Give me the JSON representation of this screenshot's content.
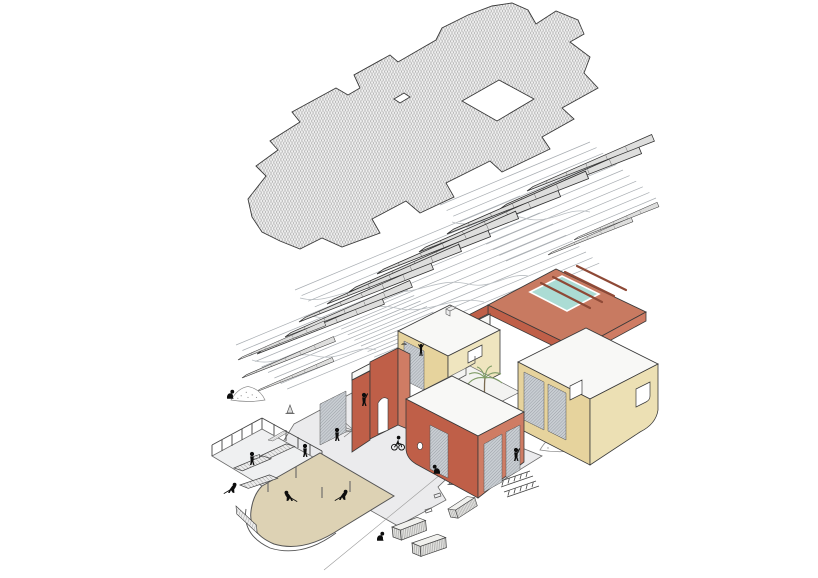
{
  "diagram": {
    "kind": "exploded-axonometric-construction-drawing",
    "layers": [
      "roof-plane-hatched",
      "truss-and-purlin-framing",
      "building-walls",
      "ground-plane-site-works"
    ]
  },
  "colors": {
    "background": "#ffffff",
    "line": "#3a3a3a",
    "roof_base": "#f0f0f0",
    "roof_hatch": "#6e6e6e",
    "purlin": "#a8adb2",
    "truss_fill": "#dededd",
    "terracotta": "#bf5f48",
    "terracotta_light": "#cf7c64",
    "terracotta_deck": "#c87a61",
    "beam_dark": "#8e4936",
    "wall_yellow": "#e6d39d",
    "wall_yellow_light": "#ece0b4",
    "pool": "#abdcd4",
    "slab_white": "#f8f8f6",
    "mesh": "#c9ced3",
    "ground": "#ebebed",
    "sand": "#ddd2b4",
    "figure": "#0d0d0d",
    "palm": "#7f9c66"
  },
  "purlin_bands": [
    {
      "x1": 440,
      "y1": 205,
      "x2": 590,
      "y2": 142,
      "n": 11,
      "dx": 6.6,
      "dy": 5.6
    },
    {
      "x1": 295,
      "y1": 290,
      "x2": 520,
      "y2": 196,
      "n": 13,
      "dx": 6.6,
      "dy": 5.6
    },
    {
      "x1": 236,
      "y1": 345,
      "x2": 395,
      "y2": 279,
      "n": 9,
      "dx": 6.4,
      "dy": 5.5
    }
  ],
  "stamps": [
    {
      "layer": "trusses",
      "sym": "sym-truss",
      "name": "roof-truss",
      "items": [
        {
          "x": 500,
          "y": 209,
          "r": -22.5
        },
        {
          "x": 527,
          "y": 191,
          "r": -22.5,
          "s": 0.9
        },
        {
          "x": 419,
          "y": 252,
          "r": -22.5
        },
        {
          "x": 447,
          "y": 234,
          "r": -22.5
        },
        {
          "x": 349,
          "y": 292,
          "r": -22.5
        },
        {
          "x": 377,
          "y": 274,
          "r": -22.5
        },
        {
          "x": 299,
          "y": 322,
          "r": -22.5,
          "s": 0.95
        },
        {
          "x": 327,
          "y": 304,
          "r": -22.5,
          "s": 0.95
        },
        {
          "x": 257,
          "y": 354,
          "r": -22.5,
          "s": 0.9
        },
        {
          "x": 285,
          "y": 337,
          "r": -22.5,
          "s": 0.9
        },
        {
          "x": 238,
          "y": 360,
          "r": -22.5,
          "s": 0.62
        },
        {
          "x": 242,
          "y": 378,
          "r": -22.5,
          "s": 0.66
        },
        {
          "x": 256,
          "y": 392,
          "r": -22.5,
          "s": 0.55
        },
        {
          "x": 548,
          "y": 255,
          "r": -22.5,
          "s": 0.6
        },
        {
          "x": 574,
          "y": 240,
          "r": -22.5,
          "s": 0.6
        }
      ]
    },
    {
      "layer": "props",
      "sym": "sym-pallet",
      "name": "site-prop",
      "items": [
        {
          "x": 258,
          "y": 457,
          "r": -10
        },
        {
          "x": 234,
          "y": 468,
          "r": -8
        },
        {
          "x": 240,
          "y": 485,
          "r": -4
        },
        {
          "x": 236,
          "y": 506,
          "r": 58,
          "s": 0.9
        },
        {
          "x": 268,
          "y": 440,
          "r": -15,
          "s": 0.55
        },
        {
          "sym": "sym-gabion",
          "x": 392,
          "y": 527,
          "r": -6
        },
        {
          "sym": "sym-gabion",
          "x": 412,
          "y": 543,
          "r": -4
        },
        {
          "sym": "sym-gabion",
          "x": 448,
          "y": 509,
          "r": -18,
          "s": 0.85
        },
        {
          "sym": "sym-mound",
          "x": 248,
          "y": 400,
          "s": 0.85
        },
        {
          "sym": "sym-mound",
          "x": 560,
          "y": 450,
          "s": 1.0
        },
        {
          "sym": "sym-cone",
          "x": 290,
          "y": 413
        },
        {
          "sym": "sym-cone",
          "x": 452,
          "y": 484
        },
        {
          "sym": "sym-ladder",
          "x": 498,
          "y": 482
        },
        {
          "sym": "sym-ladder",
          "x": 504,
          "y": 492
        },
        {
          "sym": "sym-frame",
          "x": 434,
          "y": 495
        },
        {
          "sym": "sym-frame",
          "x": 425,
          "y": 510
        }
      ]
    },
    {
      "layer": "figures",
      "sym": "fig-stand",
      "name": "worker-figure",
      "items": [
        {
          "sym": "fig-crouch",
          "x": 230,
          "y": 399
        },
        {
          "sym": "fig-carry",
          "x": 252,
          "y": 465
        },
        {
          "sym": "fig-work",
          "x": 231,
          "y": 493,
          "sx": -1
        },
        {
          "sym": "fig-stand",
          "x": 305,
          "y": 457
        },
        {
          "sym": "fig-stand",
          "x": 337,
          "y": 441
        },
        {
          "sym": "fig-arm",
          "x": 364,
          "y": 406
        },
        {
          "sym": "fig-cyclist",
          "x": 398,
          "y": 450
        },
        {
          "sym": "fig-work",
          "x": 290,
          "y": 501
        },
        {
          "sym": "fig-work",
          "x": 342,
          "y": 500,
          "sx": -1
        },
        {
          "sym": "fig-crouch",
          "x": 437,
          "y": 474,
          "sx": -1
        },
        {
          "sym": "fig-crouch",
          "x": 380,
          "y": 541
        },
        {
          "sym": "fig-arm",
          "x": 516,
          "y": 461
        },
        {
          "sym": "fig-climb",
          "x": 421,
          "y": 356,
          "s": 0.9
        },
        {
          "sym": "sym-bird",
          "x": 404,
          "y": 345
        }
      ]
    }
  ]
}
